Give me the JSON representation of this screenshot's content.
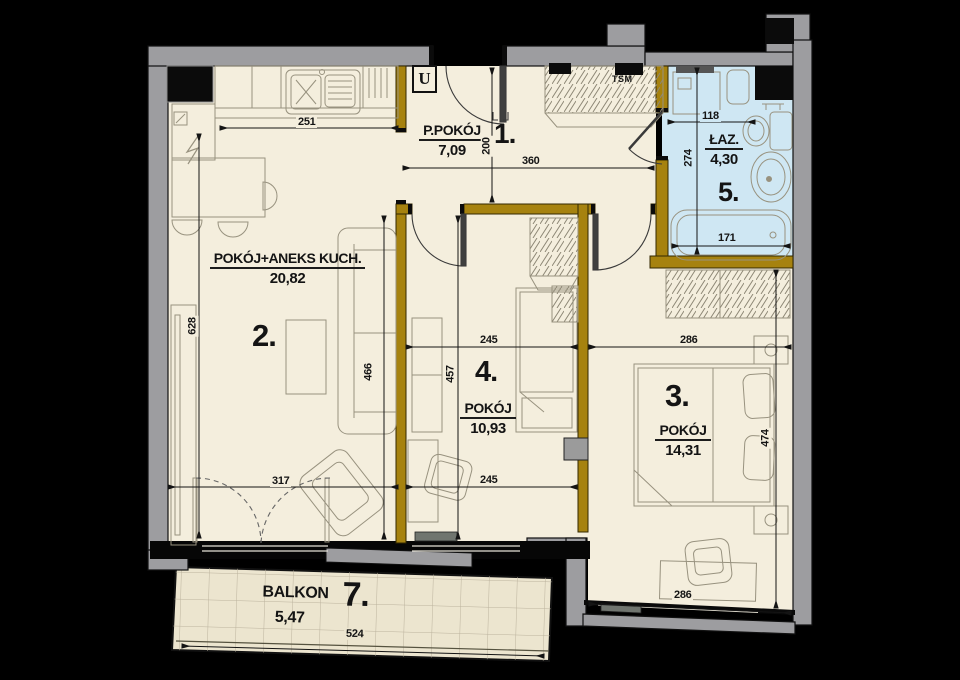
{
  "title": "apartment-floor-plan",
  "rooms": {
    "hall": {
      "number": "1.",
      "name": "P.POKÓJ",
      "area": "7,09"
    },
    "living": {
      "number": "2.",
      "name": "POKÓJ+ANEKS KUCH.",
      "area": "20,82"
    },
    "bedroom_large": {
      "number": "3.",
      "name": "POKÓJ",
      "area": "14,31"
    },
    "bedroom_small": {
      "number": "4.",
      "name": "POKÓJ",
      "area": "10,93"
    },
    "bathroom": {
      "number": "5.",
      "name": "ŁAZ.",
      "area": "4,30"
    },
    "balcony": {
      "number": "7.",
      "name": "BALKON",
      "area": "5,47"
    }
  },
  "annotations": {
    "utility_label": "U",
    "wardrobe_label": "TSM"
  },
  "dimensions": {
    "kitchen_width": "251",
    "living_height": "628",
    "living_bottom_width": "317",
    "living_right_height": "466",
    "hall_width": "360",
    "hall_depth": "200",
    "room4_top_width": "245",
    "room4_height": "457",
    "room4_bottom_width": "245",
    "room3_top_width": "286",
    "room3_height": "474",
    "room3_bottom_width": "286",
    "bath_top_width": "118",
    "bath_height": "274",
    "bathtub_width": "171",
    "balcony_width": "524"
  },
  "colors": {
    "background": "#000000",
    "floor": "#f4eedd",
    "bathroom_floor": "#cfe7f3",
    "balcony_floor": "#ece5cf",
    "interior_wall": "#a6820f",
    "exterior_wall": "#9d9da0"
  }
}
